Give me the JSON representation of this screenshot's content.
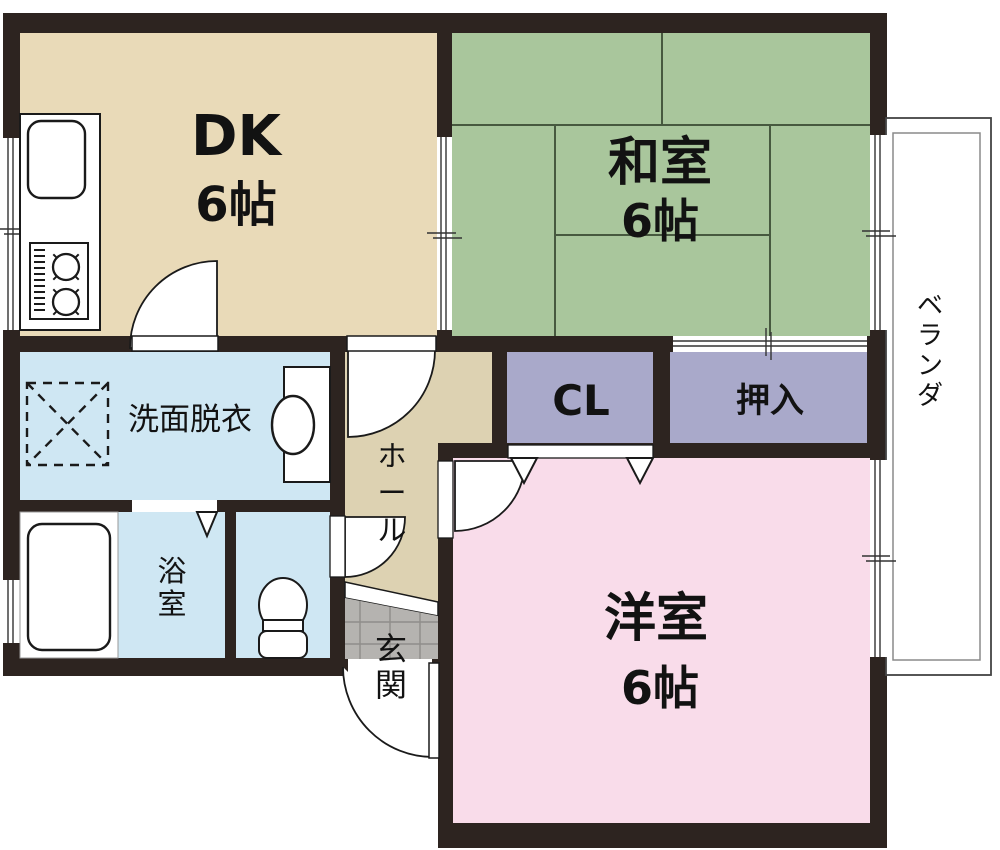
{
  "plan": {
    "type": "floor-plan",
    "rooms": {
      "dk": {
        "label": "DK",
        "size": "6帖"
      },
      "japanese_room": {
        "label": "和室",
        "size": "6帖"
      },
      "western_room": {
        "label": "洋室",
        "size": "6帖"
      },
      "closet": {
        "label": "CL"
      },
      "oshiire": {
        "label": "押入"
      },
      "washroom": {
        "label": "洗面脱衣"
      },
      "bathroom": {
        "label": "浴室"
      },
      "hall": {
        "label": "ホール"
      },
      "entrance": {
        "label": "玄関"
      },
      "veranda": {
        "label": "ベランダ"
      }
    },
    "fixtures": [
      "kitchen-sink",
      "gas-stove",
      "washing-machine-space",
      "vanity-basin",
      "bathtub",
      "toilet"
    ],
    "colors": {
      "wall": "#2d2420",
      "dk": "#e9dab8",
      "hall": "#ddd2b2",
      "japanese_room": "#a9c69c",
      "tatami_line": "#47593f",
      "western_room": "#f9dcea",
      "closet": "#a9a9ca",
      "wet_room": "#cfe7f3",
      "entrance_tile": "#b5b3b0",
      "tile_line": "#8f8d8a",
      "fixture_fill": "#ffffff"
    }
  }
}
